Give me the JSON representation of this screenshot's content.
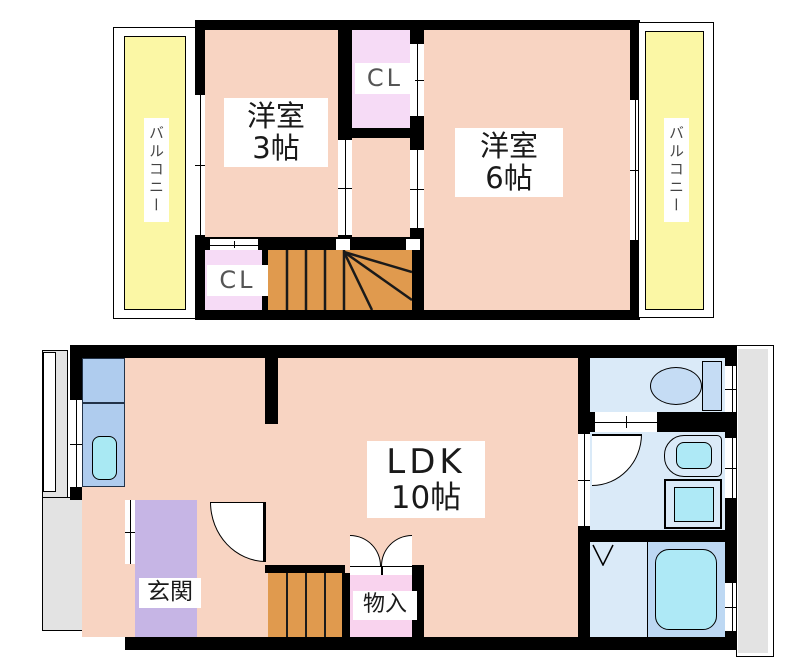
{
  "floor2": {
    "balcony_left_label": "バルコニー",
    "balcony_right_label": "バルコニー",
    "room3_line1": "洋室",
    "room3_line2": "3帖",
    "room6_line1": "洋室",
    "room6_line2": "6帖",
    "closet_top_label": "CL",
    "closet_bottom_label": "CL"
  },
  "floor1": {
    "ldk_line1": "LDK",
    "ldk_line2": "10帖",
    "entrance_label": "玄関",
    "storage_label": "物入"
  },
  "colors": {
    "room_pink": "#F8D4C2",
    "closet_pink": "#F6DBF6",
    "storage_pink": "#F9D3EE",
    "stair_orange": "#E09A4E",
    "balcony_yellow": "#FBF7A5",
    "entrance_purple": "#C6B5E5",
    "counter_blue": "#AFCCEE",
    "sink_cyan": "#A9E9F3",
    "bath_blue": "#DAEAF8",
    "fixture_blue": "#C5DCF4",
    "tub_panel_blue": "#BDD8F3",
    "tub_cyan": "#AEE9F6",
    "exterior_gray": "#E3E3E3",
    "wall_black": "#000000"
  }
}
